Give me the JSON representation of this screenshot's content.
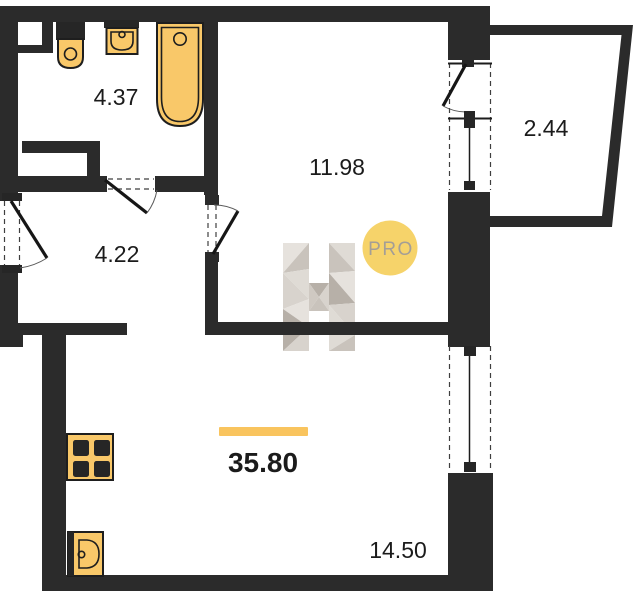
{
  "plan": {
    "type": "apartment-floor-plan",
    "badge": {
      "label": "PRO"
    },
    "total": {
      "label": "35.80"
    },
    "rooms": {
      "bathroom": {
        "label": "4.37"
      },
      "living": {
        "label": "11.98"
      },
      "balcony": {
        "label": "2.44"
      },
      "hallway": {
        "label": "4.22"
      },
      "kitchen_living": {
        "label": "14.50"
      }
    },
    "fixtures": [
      "toilet",
      "wash-basin",
      "bathtub",
      "stove",
      "kitchen-sink"
    ],
    "colors": {
      "wall": "#2b2b2b",
      "fixture": "#f9c869",
      "fixture_border": "#1e1e1e",
      "accent_bar": "#f9c45e",
      "badge_bg": "#f6d36a",
      "badge_text": "#a49e96",
      "text": "#1b1b1b",
      "logo_tones": [
        "#e6e2dd",
        "#d8d3cd",
        "#c9c3bc",
        "#b7b0a8",
        "#dfdbd5",
        "#cfc9c2"
      ]
    }
  }
}
